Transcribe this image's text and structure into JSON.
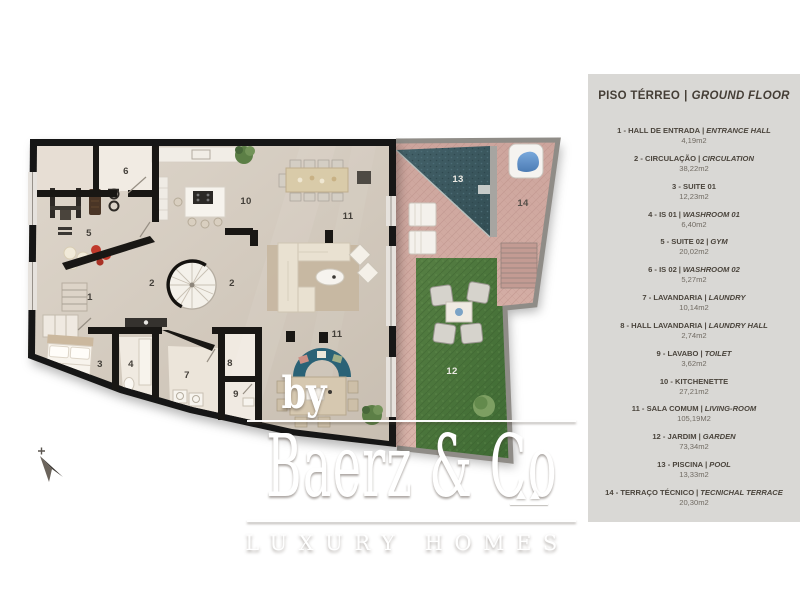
{
  "colors": {
    "walls": "#191714",
    "floor": "#d5cbbf",
    "wet_room": "#f0eae1",
    "pool": "#3c575d",
    "garden": "#4e7b40",
    "terrace": "#d2a89f",
    "outdoor_wall": "#8f8c87",
    "legend_bg": "#d9d8d5",
    "legend_text": "#4a443c",
    "label_dark": "#44403a",
    "label_light": "#eceae4"
  },
  "plan": {
    "room_labels": [
      {
        "t": "1",
        "x": 90,
        "y": 300,
        "c": "#44403a"
      },
      {
        "t": "2",
        "x": 152,
        "y": 286,
        "c": "#44403a"
      },
      {
        "t": "2",
        "x": 232,
        "y": 286,
        "c": "#44403a"
      },
      {
        "t": "3",
        "x": 100,
        "y": 367,
        "c": "#44403a"
      },
      {
        "t": "4",
        "x": 131,
        "y": 367,
        "c": "#44403a"
      },
      {
        "t": "5",
        "x": 89,
        "y": 236,
        "c": "#44403a"
      },
      {
        "t": "6",
        "x": 126,
        "y": 174,
        "c": "#44403a"
      },
      {
        "t": "7",
        "x": 187,
        "y": 378,
        "c": "#44403a"
      },
      {
        "t": "8",
        "x": 230,
        "y": 366,
        "c": "#44403a"
      },
      {
        "t": "9",
        "x": 236,
        "y": 397,
        "c": "#44403a"
      },
      {
        "t": "10",
        "x": 246,
        "y": 204,
        "c": "#44403a"
      },
      {
        "t": "11",
        "x": 348,
        "y": 219,
        "c": "#44403a"
      },
      {
        "t": "11",
        "x": 337,
        "y": 337,
        "c": "#44403a"
      },
      {
        "t": "12",
        "x": 452,
        "y": 374,
        "c": "#eceae4"
      },
      {
        "t": "13",
        "x": 458,
        "y": 182,
        "c": "#eceae4"
      },
      {
        "t": "14",
        "x": 523,
        "y": 206,
        "c": "#56504a"
      }
    ]
  },
  "watermark": {
    "by": "by",
    "brand": "Baerz & Co",
    "tagline": "LUXURY HOMES"
  },
  "legend": {
    "title_pt": "PISO TÉRREO",
    "separator": "|",
    "title_en": "GROUND FLOOR",
    "items": [
      {
        "name_pt": "1 - HALL DE ENTRADA",
        "name_en": "ENTRANCE HALL",
        "area": "4,19m2"
      },
      {
        "name_pt": "2 - CIRCULAÇÃO",
        "name_en": "CIRCULATION",
        "area": "38,22m2"
      },
      {
        "name_pt": "3 - SUITE 01",
        "name_en": null,
        "area": "12,23m2"
      },
      {
        "name_pt": "4 - IS 01",
        "name_en": "WASHROOM 01",
        "area": "6,40m2"
      },
      {
        "name_pt": "5 - SUITE 02",
        "name_en": "GYM",
        "area": "20,02m2"
      },
      {
        "name_pt": "6 - IS 02",
        "name_en": "WASHROOM 02",
        "area": "5,27m2"
      },
      {
        "name_pt": "7 - LAVANDARIA",
        "name_en": "LAUNDRY",
        "area": "10,14m2"
      },
      {
        "name_pt": "8 - HALL LAVANDARIA",
        "name_en": "LAUNDRY HALL",
        "area": "2,74m2"
      },
      {
        "name_pt": "9 - LAVABO",
        "name_en": "TOILET",
        "area": "3,62m2"
      },
      {
        "name_pt": "10 - KITCHENETTE",
        "name_en": null,
        "area": "27,21m2"
      },
      {
        "name_pt": "11 - SALA COMUM",
        "name_en": "LIVING-ROOM",
        "area": "105,19M2"
      },
      {
        "name_pt": "12 - JARDIM",
        "name_en": "GARDEN",
        "area": "73,34m2"
      },
      {
        "name_pt": "13 - PISCINA",
        "name_en": "POOL",
        "area": "13,33m2"
      },
      {
        "name_pt": "14 - TERRAÇO TÉCNICO",
        "name_en": "TECNICHAL TERRACE",
        "area": "20,30m2"
      }
    ]
  }
}
